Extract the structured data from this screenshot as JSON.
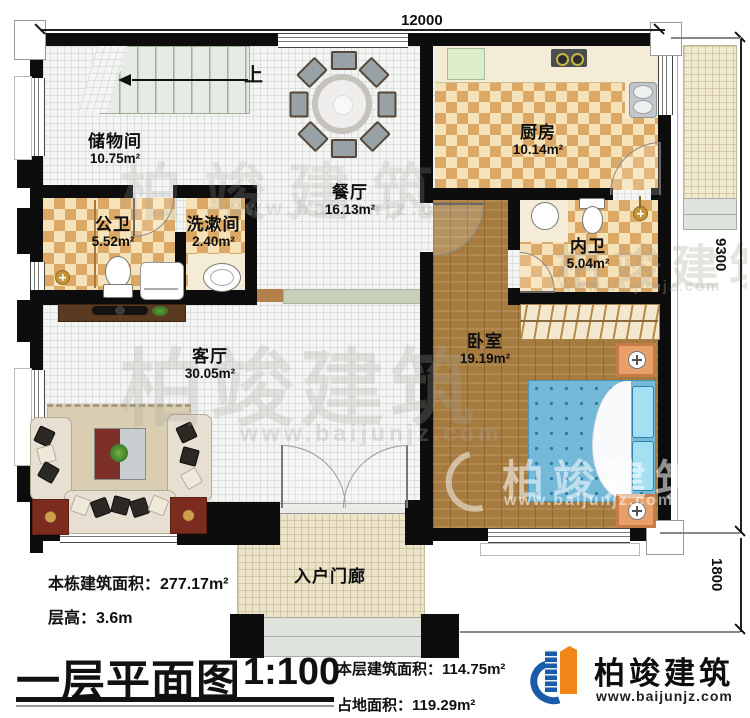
{
  "page": {
    "title": "一层平面图",
    "scale": "1:100"
  },
  "plan": {
    "up_label": "上"
  },
  "rooms": {
    "storage": {
      "name": "储物间",
      "area": "10.75m²"
    },
    "public_bath": {
      "name": "公卫",
      "area": "5.52m²"
    },
    "washroom": {
      "name": "洗漱间",
      "area": "2.40m²"
    },
    "dining": {
      "name": "餐厅",
      "area": "16.13m²"
    },
    "kitchen": {
      "name": "厨房",
      "area": "10.14m²"
    },
    "inner_bath": {
      "name": "内卫",
      "area": "5.04m²"
    },
    "bedroom": {
      "name": "卧室",
      "area": "19.19m²"
    },
    "living": {
      "name": "客厅",
      "area": "30.05m²"
    },
    "porch": {
      "name": "入户门廊",
      "area": ""
    }
  },
  "dimensions": {
    "top": "12000",
    "right_upper": "9300",
    "right_lower": "1800"
  },
  "stats": {
    "building_area_label": "本栋建筑面积：",
    "building_area_value": "277.17m²",
    "floor_height_label": "层高：",
    "floor_height_value": "3.6m",
    "floor_area_label": "本层建筑面积：",
    "floor_area_value": "114.75m²",
    "footprint_label": "占地面积：",
    "footprint_value": "119.29m²"
  },
  "brand": {
    "name": "柏竣建筑",
    "site": "www.baijunjz.com"
  },
  "watermark": {
    "name": "柏竣建筑",
    "site": "www.baijunjz.com"
  },
  "colors": {
    "wall": "#0d0d0d",
    "checker_a": "#dca865",
    "checker_b": "#f6e2b8",
    "wood": "#a57b40",
    "bed": "#74b9d8",
    "brand_blue": "#1a5ca8",
    "brand_orange": "#f08519",
    "grid_floor": "#f4f5f2",
    "porch_floor": "#ece4ca"
  }
}
